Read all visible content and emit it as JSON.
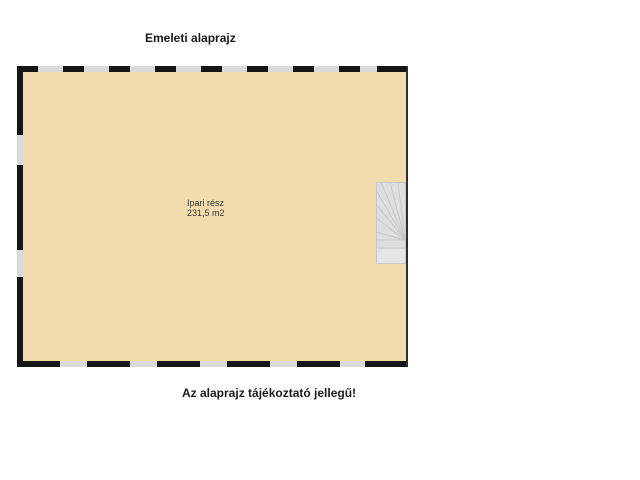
{
  "page": {
    "title": "Emeleti alaprajz",
    "disclaimer": "Az alaprajz tájékoztató jellegű!"
  },
  "floor_plan": {
    "room_label": {
      "name": "Ipari rész",
      "area": "231,5 m2"
    },
    "colors": {
      "floor_fill": "#f2dbad",
      "wall": "#161616",
      "window_gap": "#d9d9d9",
      "right_wall": "#2e2e2e",
      "stairs_fill": "#dcdee0",
      "stairs_line": "#c2c5c8"
    }
  }
}
